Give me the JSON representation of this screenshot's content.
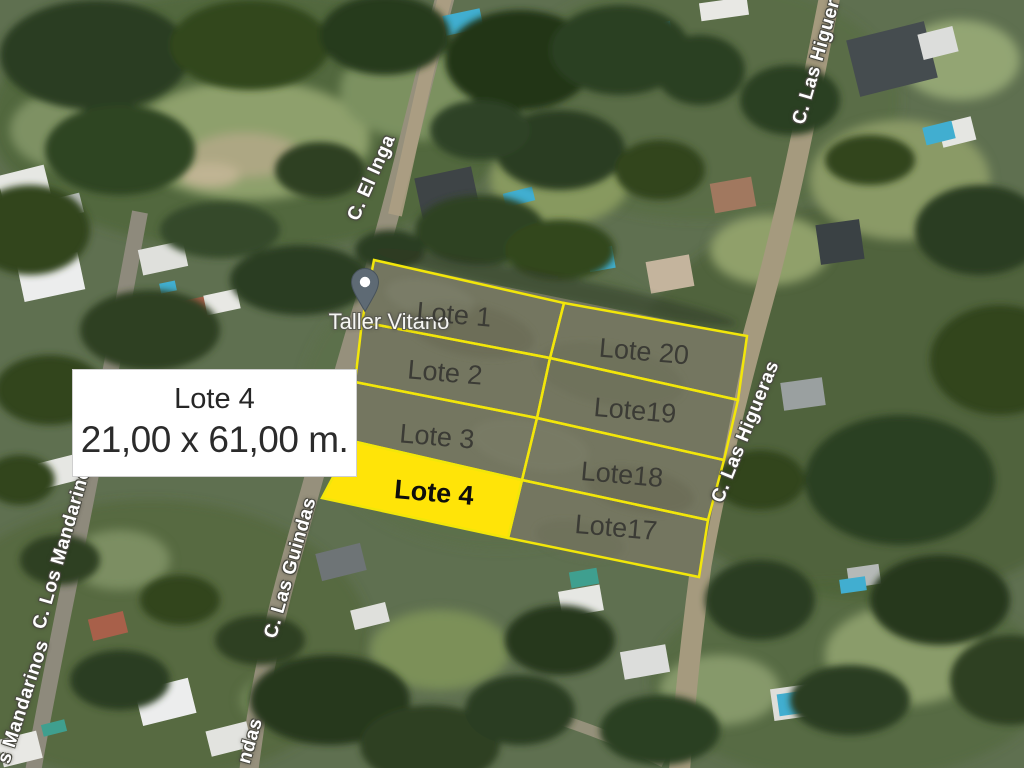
{
  "map": {
    "poi": {
      "name": "Taller Vitano"
    },
    "streets": {
      "el_inga": "C. El Inga",
      "las_higueras_top": "C. Las Higuer",
      "las_higueras": "C. Las Higueras",
      "las_guindas": "C. Las Guindas",
      "las_guindas_fragment": "ndas",
      "los_mandarinos": "C. Los Mandarinos",
      "los_mandarinos_fragment": "s Mandarinos"
    },
    "lots": [
      {
        "id": "lote-1",
        "label": "Lote 1"
      },
      {
        "id": "lote-2",
        "label": "Lote 2"
      },
      {
        "id": "lote-3",
        "label": "Lote 3"
      },
      {
        "id": "lote-4",
        "label": "Lote 4",
        "highlighted": true
      },
      {
        "id": "lote-20",
        "label": "Lote 20"
      },
      {
        "id": "lote-19",
        "label": "Lote19"
      },
      {
        "id": "lote-18",
        "label": "Lote18"
      },
      {
        "id": "lote-17",
        "label": "Lote17"
      }
    ],
    "info_box": {
      "title": "Lote 4",
      "dimensions": "21,00 x 61,00 m."
    },
    "colors": {
      "lot_stroke": "#f2e60a",
      "lot_highlight_fill": "#ffe408",
      "lot_block_fill": "#747660",
      "lot_label": "#3b3b35",
      "street_label": "#ffffff",
      "street_label_outline": "#4b4b42",
      "info_box_bg": "#ffffff",
      "pin": "#5e6a74",
      "pool": "#41aed0"
    }
  }
}
